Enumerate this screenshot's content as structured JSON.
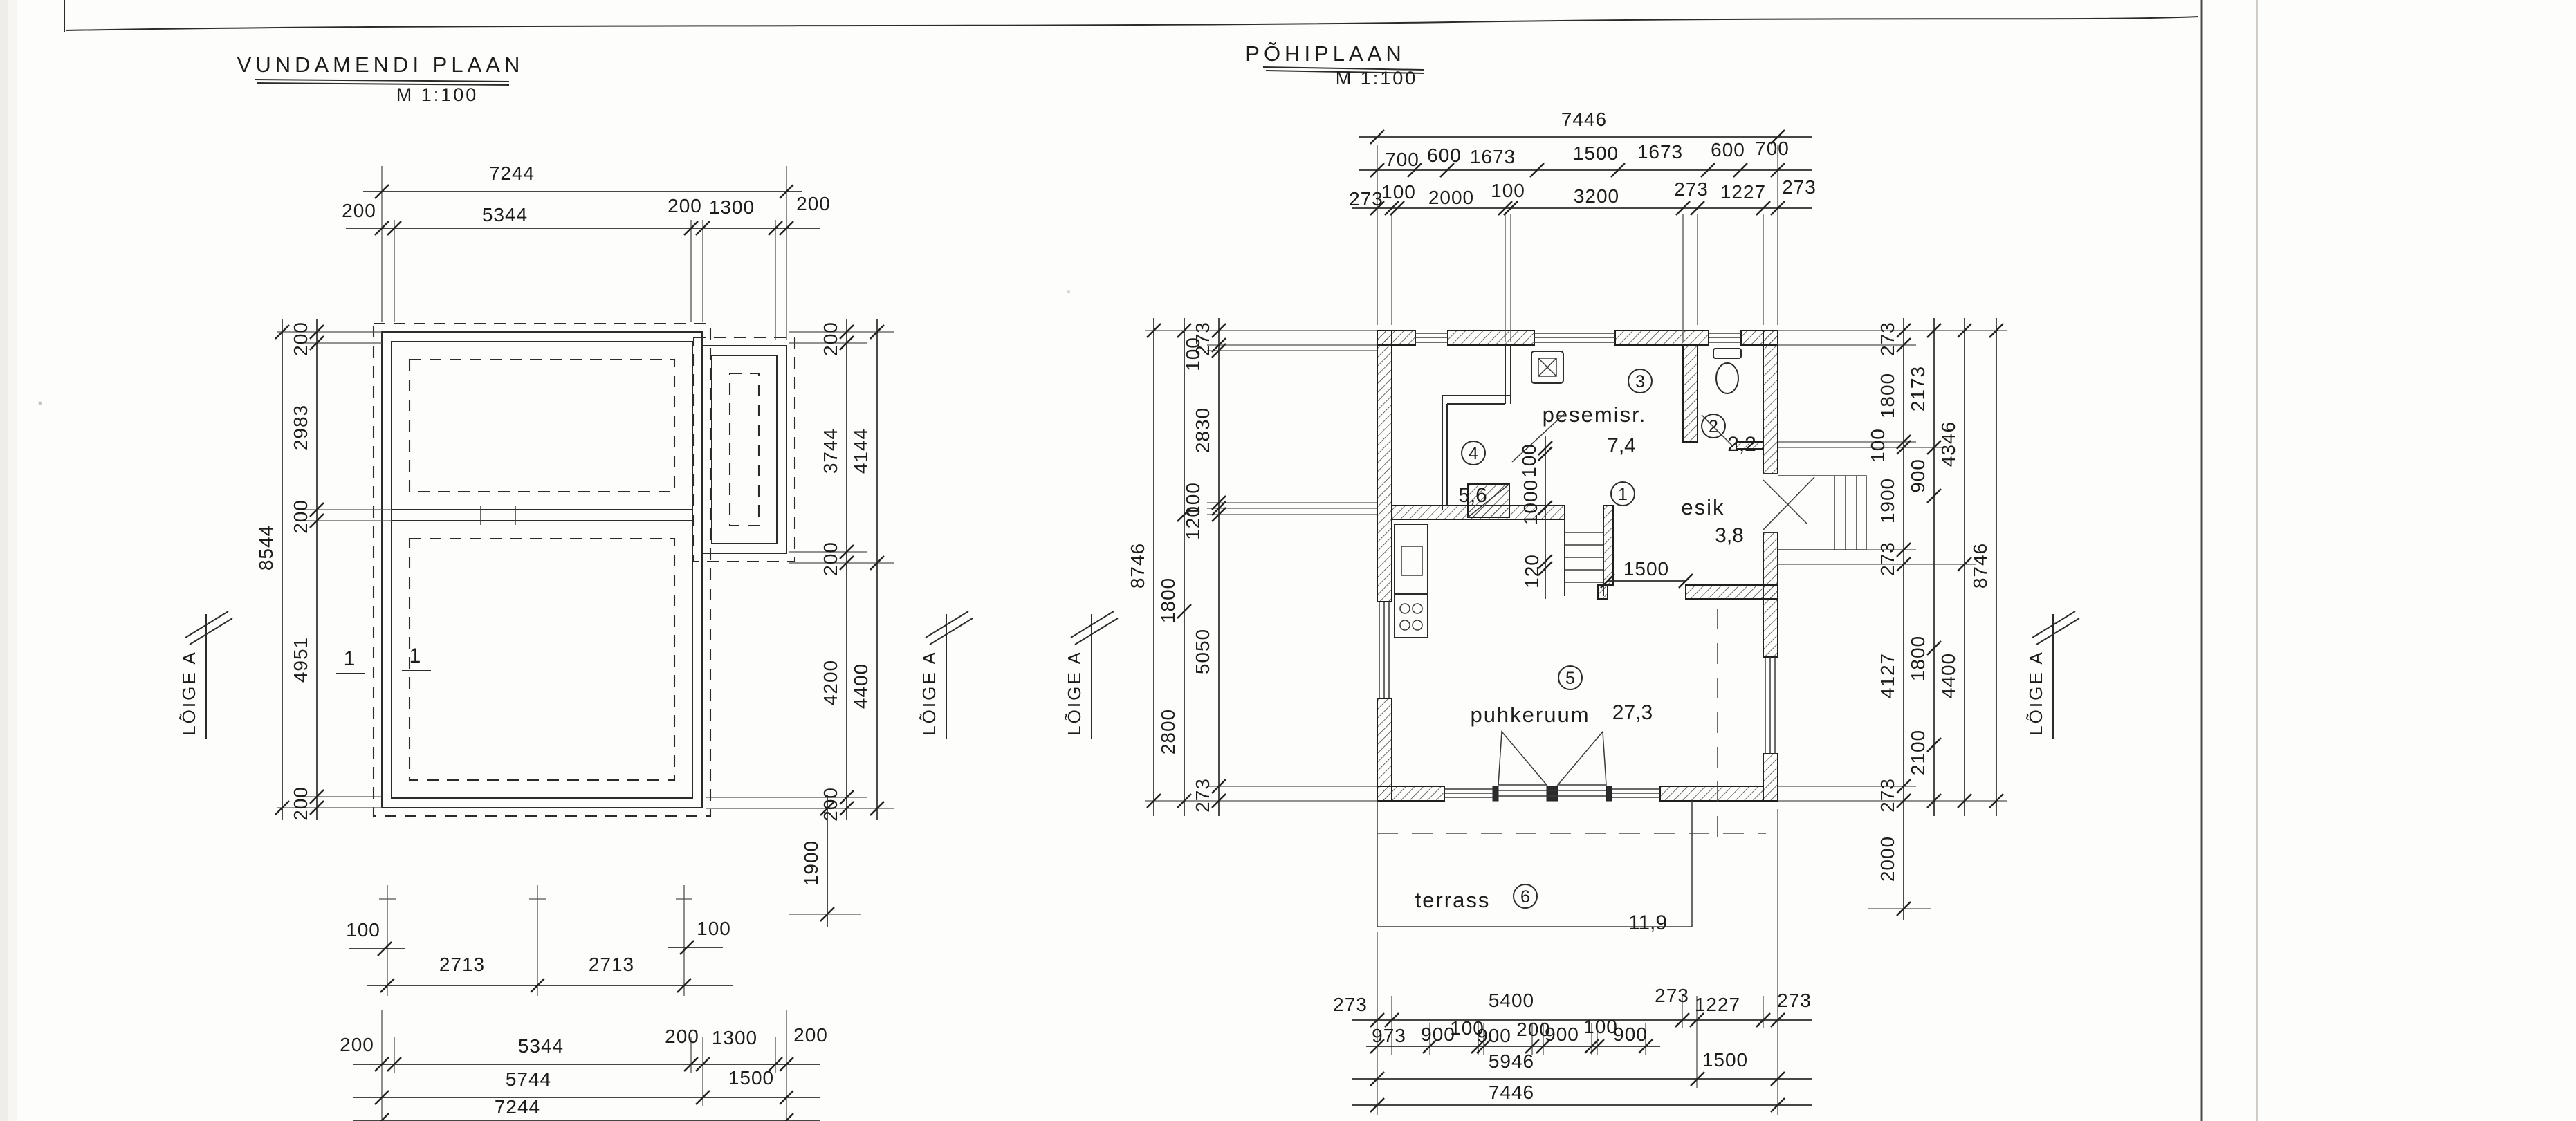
{
  "left_plan": {
    "title": "VUNDAMENDI PLAAN",
    "scale": "M 1:100",
    "section_label": "LÕIGE A",
    "axis_1": "1",
    "top": {
      "total": "7244",
      "segments": [
        "200",
        "5344",
        "200",
        "1300",
        "200"
      ]
    },
    "left": {
      "total": "8544",
      "segments": [
        "200",
        "2983",
        "200",
        "4951",
        "200"
      ]
    },
    "right": {
      "inner": [
        "200",
        "3744",
        "200",
        "4200",
        "200"
      ],
      "outer": [
        "4144",
        "4400"
      ],
      "step_depth": "1900"
    },
    "bottom": {
      "row1": [
        "100",
        "2713",
        "2713",
        "100"
      ],
      "row2": [
        "200",
        "5344",
        "200",
        "1300",
        "200"
      ],
      "row3": [
        "5744",
        "1500"
      ],
      "total": "7244"
    }
  },
  "main_plan": {
    "title": "PÕHIPLAAN",
    "scale": "M 1:100",
    "section_label": "LÕIGE A",
    "top": {
      "total": "7446",
      "row2": [
        "700",
        "600",
        "1673",
        "1500",
        "1673",
        "600",
        "700"
      ],
      "row3": [
        "273",
        "100",
        "2000",
        "100",
        "3200",
        "273",
        "1227",
        "273"
      ]
    },
    "left": {
      "total": "8746",
      "inner": [
        "273",
        "100",
        "2830",
        "100",
        "120",
        "5050",
        "273"
      ],
      "middle": [
        "1800",
        "2800"
      ]
    },
    "right": {
      "total": "8746",
      "inner": [
        "273",
        "1800",
        "100",
        "1900",
        "273",
        "4127",
        "273"
      ],
      "middle": [
        "2173",
        "900",
        "1800",
        "2100"
      ],
      "outer": [
        "4346",
        "4400"
      ],
      "terrace_depth": "2000"
    },
    "bottom": {
      "row1": [
        "273",
        "5400",
        "273",
        "1227",
        "273"
      ],
      "row2": [
        "973",
        "900",
        "100",
        "900",
        "200",
        "900",
        "100",
        "900"
      ],
      "row3": [
        "5946",
        "1500"
      ],
      "total": "7446"
    },
    "interior": {
      "dim_100": "100",
      "dim_1000": "1000",
      "dim_120": "120",
      "door_width": "1500"
    },
    "rooms": [
      {
        "num": "1",
        "name": "esik",
        "area": "3,8"
      },
      {
        "num": "2",
        "name": "",
        "area": "2,2"
      },
      {
        "num": "3",
        "name": "pesemisr.",
        "area": "7,4"
      },
      {
        "num": "4",
        "name": "",
        "area": "5,6"
      },
      {
        "num": "5",
        "name": "puhkeruum",
        "area": "27,3"
      },
      {
        "num": "6",
        "name": "terrass",
        "area": "11,9"
      }
    ]
  }
}
